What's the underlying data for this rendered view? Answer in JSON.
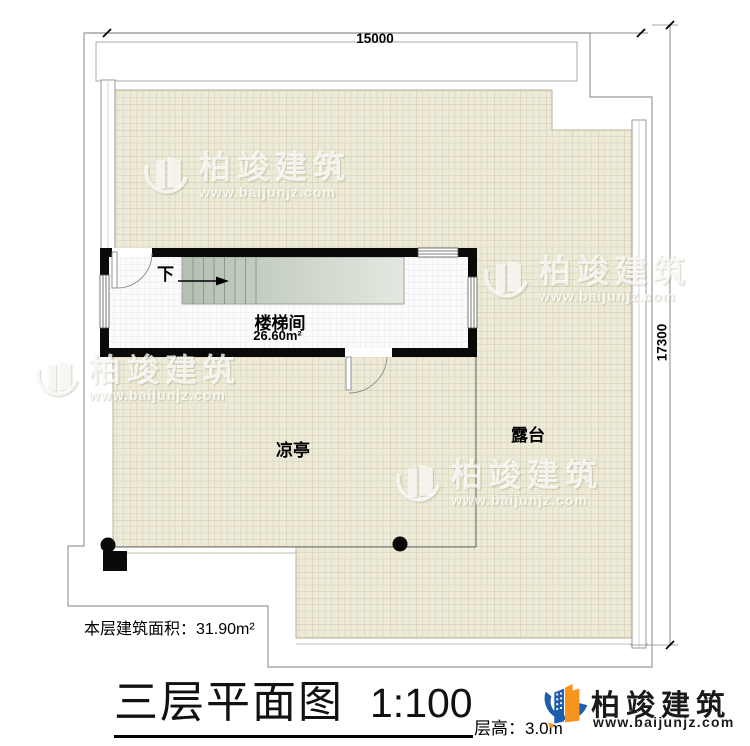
{
  "dimensions": {
    "top": "15000",
    "right": "17300"
  },
  "rooms": {
    "stair": {
      "name": "楼梯间",
      "area": "26.60m²",
      "down": "下"
    },
    "pavilion": "凉亭",
    "terrace": "露台"
  },
  "footer": {
    "floor_area": "本层建筑面积：31.90m²",
    "title": "三层平面图",
    "scale": "1:100",
    "floor_height": "层高：3.0m"
  },
  "watermark": {
    "name": "柏竣建筑",
    "url": "www.baijunjz.com"
  },
  "logo": {
    "name": "柏竣建筑",
    "url": "www.baijunjz.com"
  },
  "colors": {
    "wall": "#0a0a0a",
    "tile_beige": "#edead9",
    "stair_green": "#b5c0b2",
    "logo_orange": "#f7941d",
    "logo_blue": "#1d5dab"
  }
}
